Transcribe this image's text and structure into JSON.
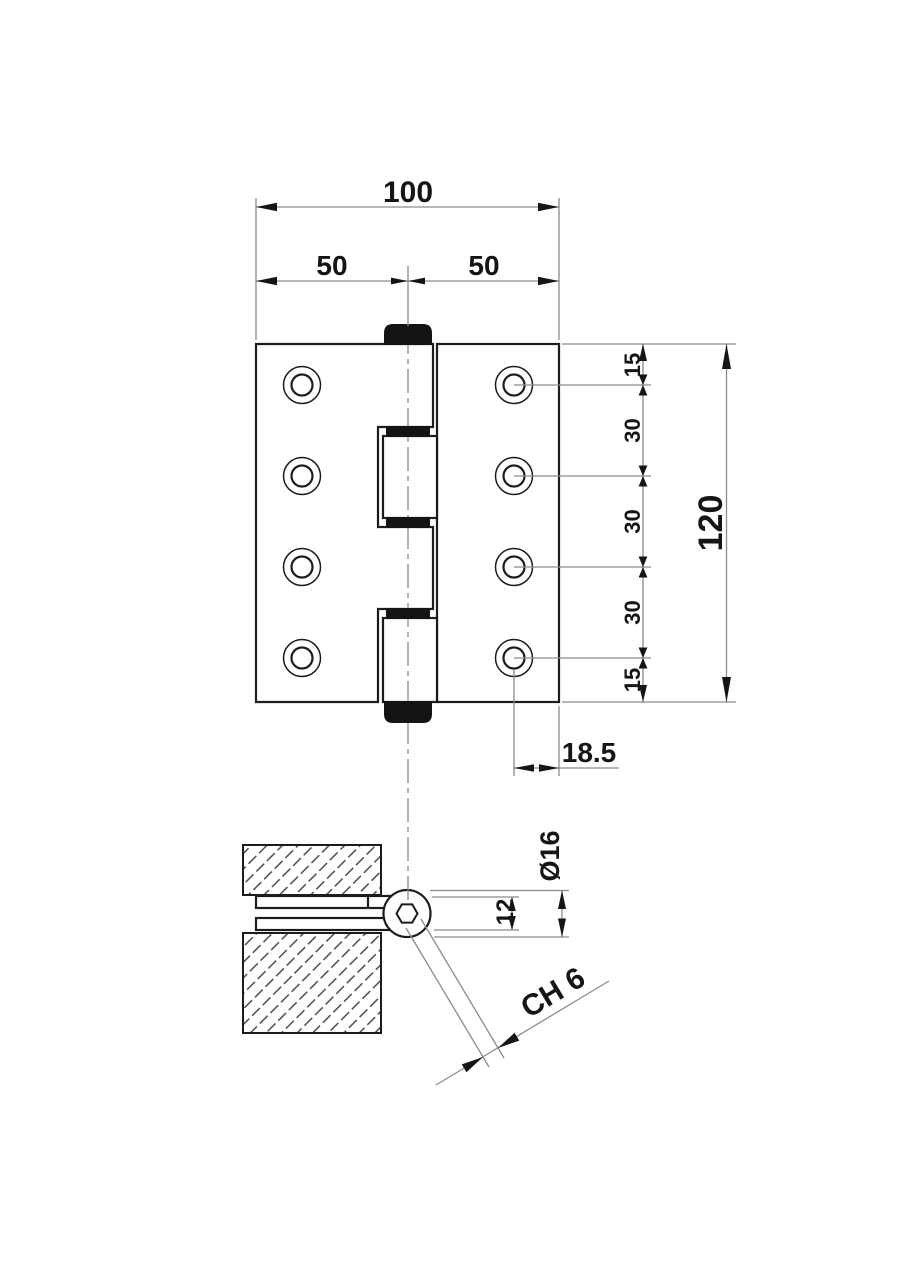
{
  "drawing": {
    "background": "#ffffff",
    "line_color": "#1c1c1c",
    "thin_line_color": "#8c8c8c",
    "dimensions": {
      "overall_width": "100",
      "left_leaf_width": "50",
      "right_leaf_width": "50",
      "overall_height": "120",
      "hole_pitch": [
        "15",
        "30",
        "30",
        "30",
        "15"
      ],
      "hole_to_edge": "18.5",
      "knuckle_diameter": "Ø16",
      "closed_thickness": "12",
      "hex_socket": "CH 6"
    }
  }
}
